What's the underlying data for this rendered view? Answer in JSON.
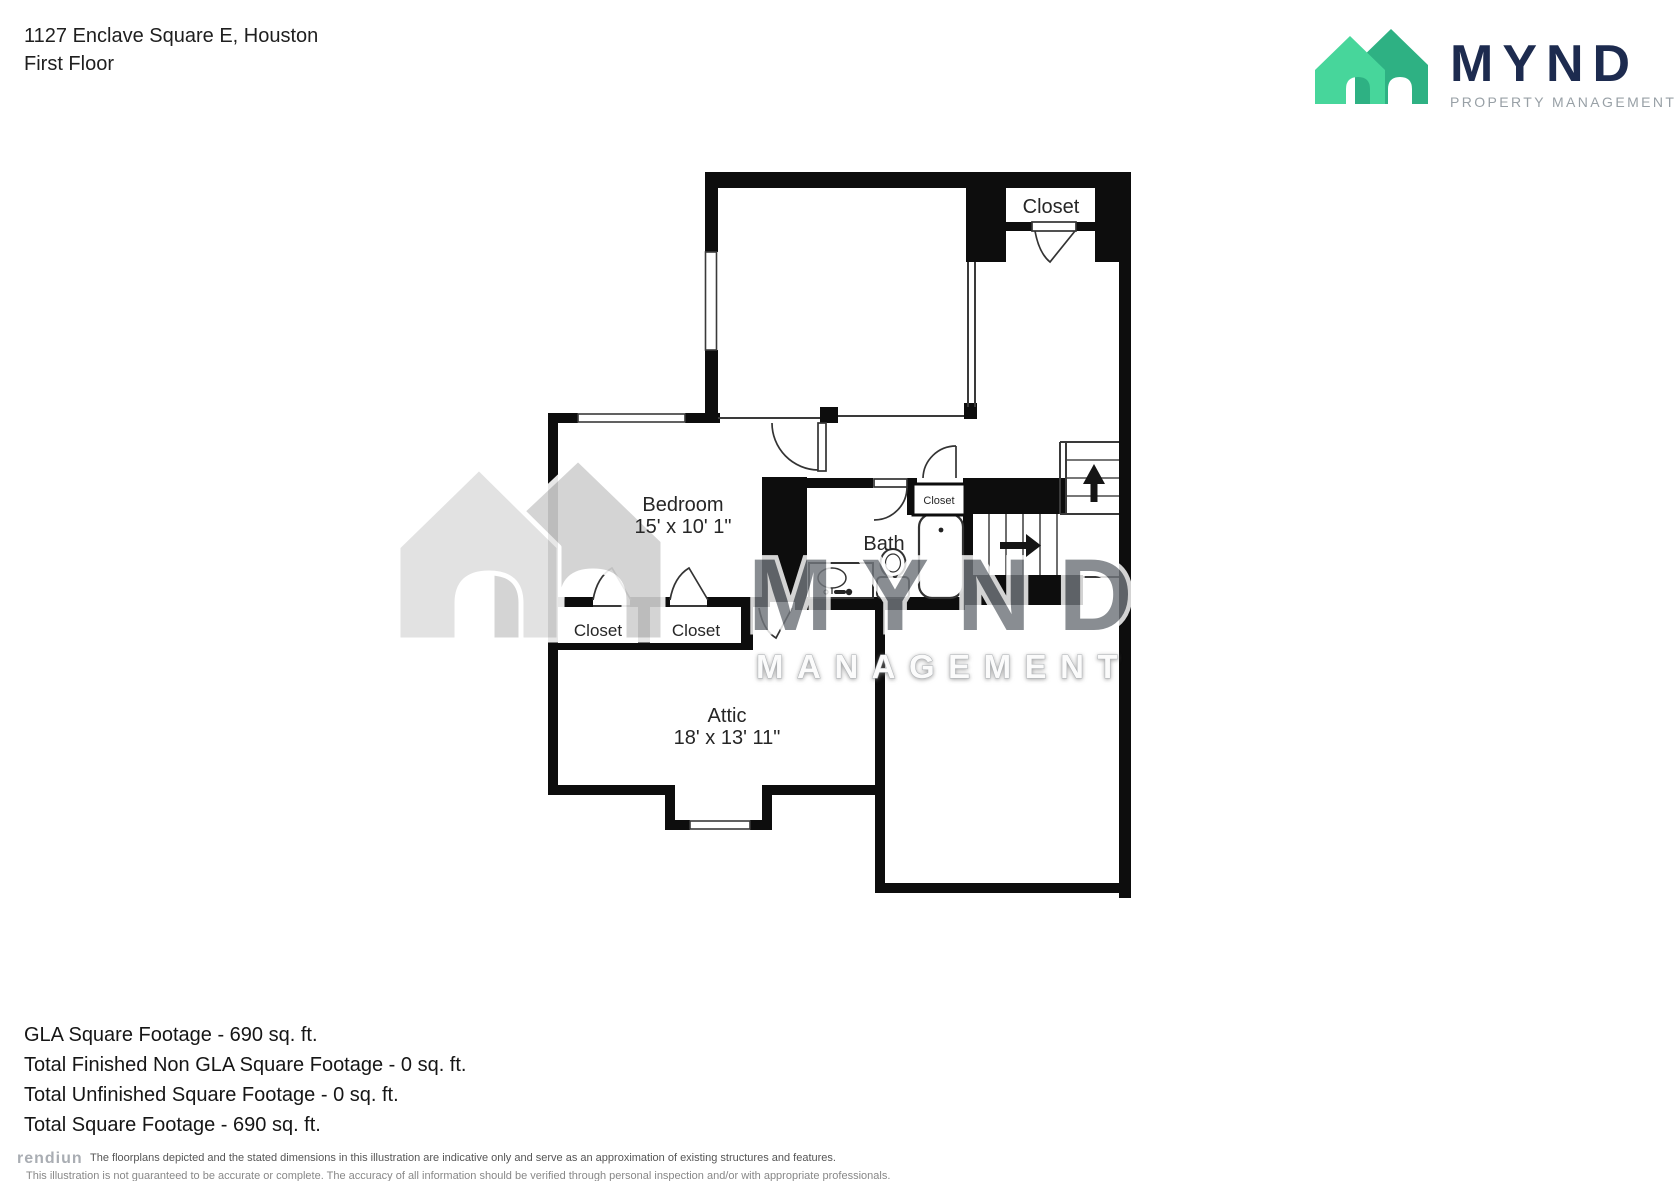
{
  "header": {
    "address": "1127 Enclave Square E, Houston",
    "floor_label": "First Floor"
  },
  "logo": {
    "wordmark": "MYND",
    "tagline": "PROPERTY MANAGEMENT",
    "house_front_color": "#47d69b",
    "house_back_color": "#2eb183",
    "wordmark_color": "#1d2b4f",
    "tagline_color": "#98a0a6"
  },
  "plan": {
    "wall_color": "#0d0d0d",
    "labels": {
      "closet_top": "Closet",
      "bedroom_name": "Bedroom",
      "bedroom_dims": "15' x 10' 1\"",
      "bath": "Bath",
      "closet_small": "Closet",
      "closet_one": "Closet",
      "closet_two": "Closet",
      "attic_name": "Attic",
      "attic_dims": "18' x 13' 11\""
    }
  },
  "watermark": {
    "word": "MYND",
    "tagline": "MANAGEMENT"
  },
  "summary": {
    "lines": [
      "GLA Square Footage - 690 sq. ft.",
      "Total Finished Non GLA Square Footage - 0 sq. ft.",
      "Total Unfinished Square Footage - 0 sq. ft.",
      "Total Square Footage - 690 sq. ft."
    ]
  },
  "disclaimer": {
    "logo_text": "rendiun",
    "line1": "The floorplans depicted and the stated dimensions in this illustration are indicative only and serve as an approximation of existing structures and features.",
    "line2": "This illustration is not guaranteed to be accurate or complete. The accuracy of all information should be verified through personal inspection and/or with appropriate professionals."
  }
}
